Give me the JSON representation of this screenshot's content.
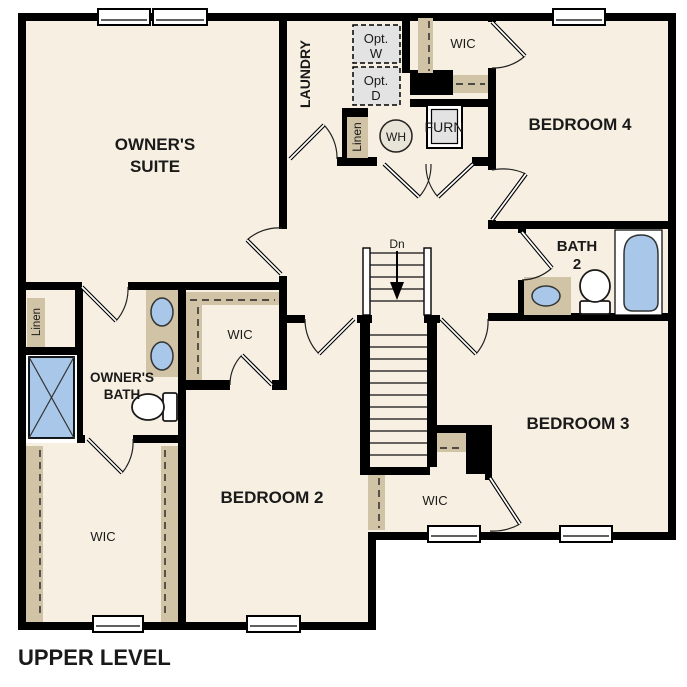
{
  "title": "UPPER LEVEL",
  "rooms": {
    "owners_suite": {
      "name_line1": "OWNER'S",
      "name_line2": "SUITE"
    },
    "laundry": {
      "name": "LAUNDRY"
    },
    "bedroom4": {
      "name": "BEDROOM 4"
    },
    "bedroom3": {
      "name": "BEDROOM 3"
    },
    "bedroom2": {
      "name": "BEDROOM 2"
    },
    "bath2": {
      "name_line1": "BATH",
      "name_line2": "2"
    },
    "owners_bath": {
      "name_line1": "OWNER'S",
      "name_line2": "BATH"
    },
    "wic_top": {
      "name": "WIC"
    },
    "wic_bedroom2": {
      "name": "WIC"
    },
    "wic_owners": {
      "name": "WIC"
    },
    "wic_bedroom3": {
      "name": "WIC"
    },
    "linen_laundry": {
      "name": "Linen"
    },
    "linen_owners": {
      "name": "Linen"
    }
  },
  "fixtures": {
    "washer_opt_line1": "Opt.",
    "washer_opt_line2": "W",
    "dryer_opt_line1": "Opt.",
    "dryer_opt_line2": "D",
    "water_heater": "WH",
    "furnace": "FURN",
    "stairs_direction": "Dn"
  },
  "colors": {
    "wall": "#000000",
    "floor": "#f7f0e2",
    "casework_tan": "#d0c3a6",
    "fixture_blue": "#a9c8e9",
    "appliance_gray": "#e3e3e3",
    "background": "#ffffff"
  }
}
